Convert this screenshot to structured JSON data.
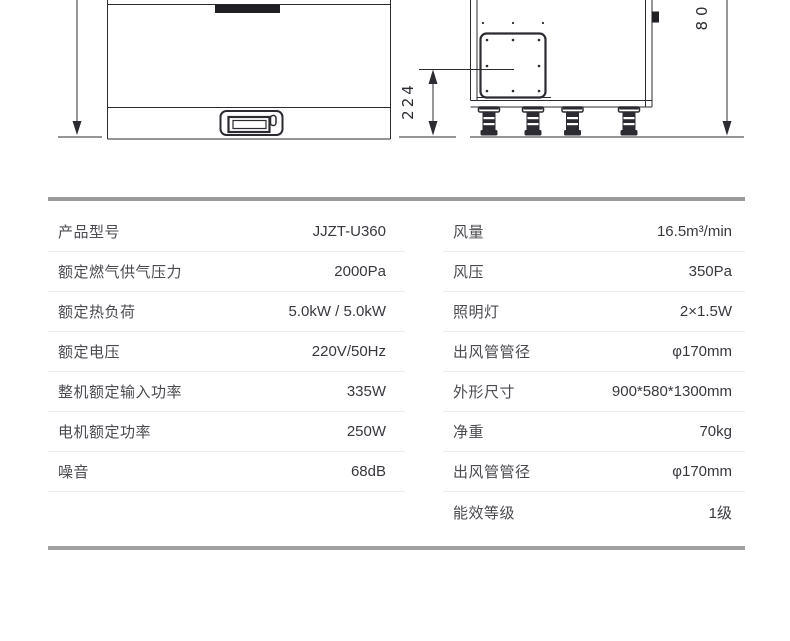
{
  "drawing": {
    "dim_depth": "224",
    "dim_height": "80"
  },
  "colors": {
    "line": "#2b2b31",
    "fill_dark": "#1f1f24",
    "table_border": "#9b9b9b",
    "row_divider": "#ececec",
    "label_text": "#4a4a50",
    "value_text": "#38383f"
  },
  "spec_table": {
    "left_column": [
      {
        "label": "产品型号",
        "value": "JJZT-U360"
      },
      {
        "label": "额定燃气供气压力",
        "value": "2000Pa"
      },
      {
        "label": "额定热负荷",
        "value": "5.0kW / 5.0kW"
      },
      {
        "label": "额定电压",
        "value": "220V/50Hz"
      },
      {
        "label": "整机额定输入功率",
        "value": "335W"
      },
      {
        "label": "电机额定功率",
        "value": "250W"
      },
      {
        "label": "噪音",
        "value": "68dB"
      }
    ],
    "right_column": [
      {
        "label": "风量",
        "value": "16.5m³/min"
      },
      {
        "label": "风压",
        "value": "350Pa"
      },
      {
        "label": "照明灯",
        "value": "2×1.5W"
      },
      {
        "label": "出风管管径",
        "value": "φ170mm"
      },
      {
        "label": "外形尺寸",
        "value": "900*580*1300mm"
      },
      {
        "label": "净重",
        "value": "70kg"
      },
      {
        "label": "出风管管径",
        "value": "φ170mm"
      },
      {
        "label": "能效等级",
        "value": "1级"
      }
    ]
  }
}
